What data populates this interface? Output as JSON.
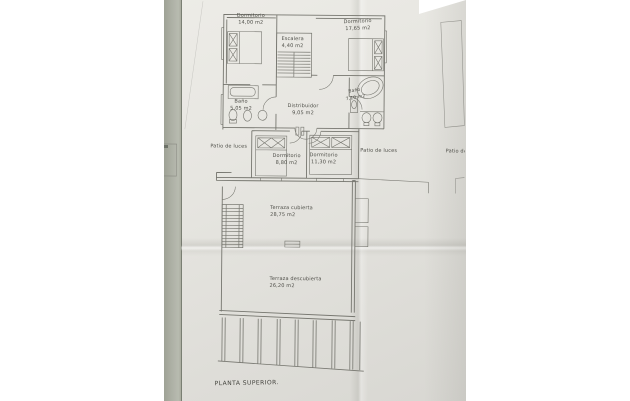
{
  "photo": {
    "paper_color": "#e6e5e0",
    "edge_strip_color": "#adb0a5",
    "line_color": "#76766f",
    "text_color": "#4e4e48"
  },
  "plan": {
    "title": "PLANTA SUPERIOR.",
    "rooms": [
      {
        "id": "dormitorio-1",
        "label": "Dormitorio",
        "area": "14,00 m2"
      },
      {
        "id": "dormitorio-2",
        "label": "Dormitorio",
        "area": "17,65 m2"
      },
      {
        "id": "escalera",
        "label": "Escalera",
        "area": "4,40 m2"
      },
      {
        "id": "bano-1",
        "label": "Baño",
        "area": "5,05 m2"
      },
      {
        "id": "distribuidor",
        "label": "Distribuidor",
        "area": "9,05 m2"
      },
      {
        "id": "bano-2",
        "label": "Baño",
        "area": "7,10 m2"
      },
      {
        "id": "dormitorio-3",
        "label": "Dormitorio",
        "area": "8,80 m2"
      },
      {
        "id": "dormitorio-4",
        "label": "Dormitorio",
        "area": "11,30 m2"
      },
      {
        "id": "terraza-cubierta",
        "label": "Terraza cubierta",
        "area": "28,75 m2"
      },
      {
        "id": "terraza-descubierta",
        "label": "Terraza descubierta",
        "area": "26,20 m2"
      }
    ],
    "patios": [
      {
        "label": "Patio de luces"
      },
      {
        "label": "Patio de luces"
      },
      {
        "label": "Patio de luces"
      }
    ]
  }
}
